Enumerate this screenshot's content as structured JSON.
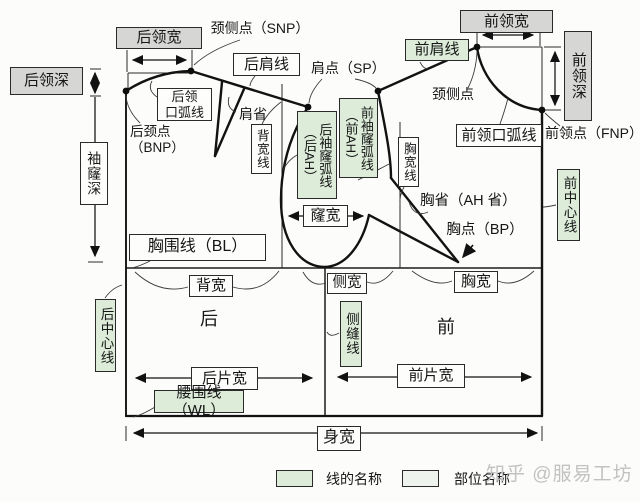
{
  "labels": {
    "back_neck_width": "后领宽",
    "snp_back": "颈侧点（SNP）",
    "back_neck_depth": "后领深",
    "back_shoulder_line": "后肩线",
    "shoulder_point": "肩点（SP）",
    "front_shoulder_line": "前肩线",
    "front_neck_width": "前领宽",
    "front_neck_depth": "前领深",
    "snp_front": "颈侧点",
    "back_neck_curve": "后领\n口弧线",
    "shoulder_dart": "肩省",
    "back_width_line": "背宽线",
    "back_neck_point": "后颈点\n（BNP）",
    "armhole_depth": "袖窿深",
    "back_armhole_curve": "后袖窿弧线\n（后AH）",
    "front_armhole_curve": "前袖窿弧线\n（前AH）",
    "chest_width_line": "胸宽线",
    "front_neck_curve": "前领口弧线",
    "front_neck_point": "前领点（FNP）",
    "armhole_width": "窿宽",
    "bust_dart": "胸省（AH 省）",
    "bust_point": "胸点（BP）",
    "front_center_line": "前中心线",
    "bust_line": "胸围线（BL）",
    "back_width": "背宽",
    "side_width": "侧宽",
    "chest_width": "胸宽",
    "back_piece": "后",
    "front_piece": "前",
    "side_seam_line": "侧缝线",
    "back_center_line": "后中心线",
    "back_piece_width": "后片宽",
    "front_piece_width": "前片宽",
    "waist_line": "腰围线（WL）",
    "body_width": "身宽"
  },
  "legend": {
    "line_name": "线的名称",
    "part_name": "部位名称",
    "line_color": "#dcecd9",
    "part_color": "#eef3ee",
    "gray_box_color": "#d6d6d5"
  },
  "watermark": "知乎 @服易工坊"
}
